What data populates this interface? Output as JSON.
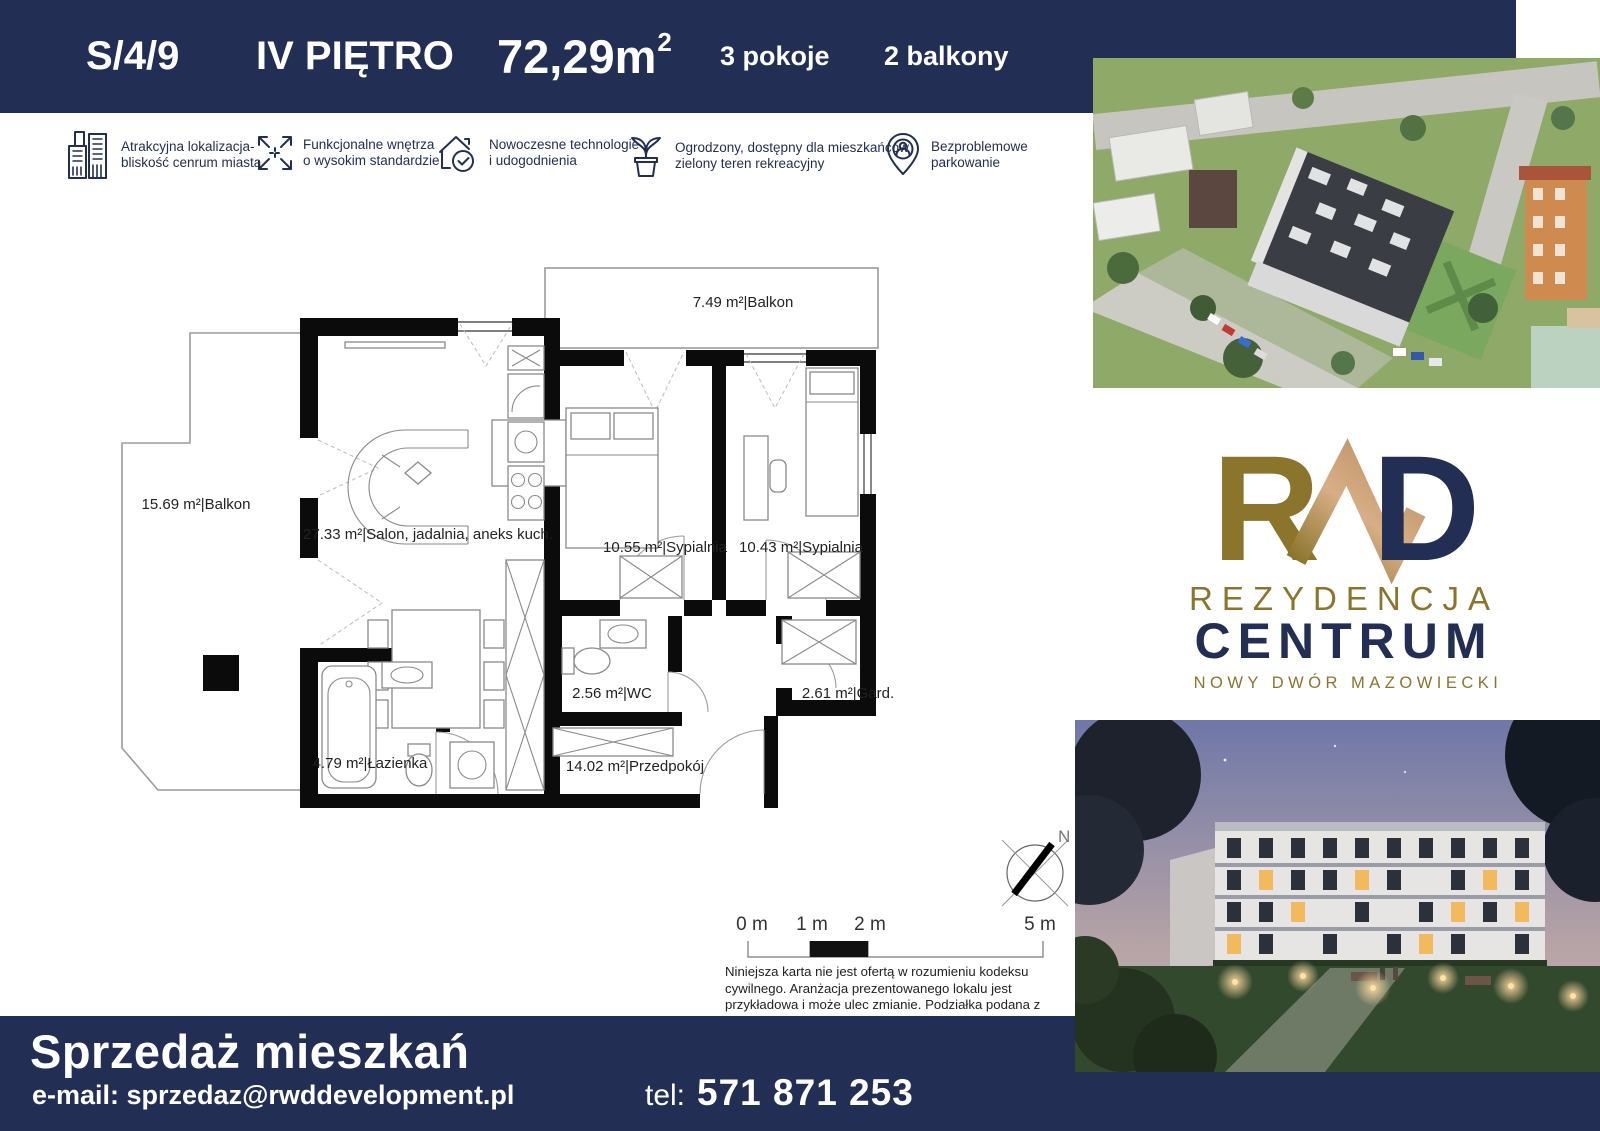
{
  "header": {
    "unit_id": "S/4/9",
    "floor": "IV PIĘTRO",
    "area_main": "72,29m",
    "area_sup": "2",
    "rooms_count": "3 pokoje",
    "balconies_count": "2 balkony"
  },
  "features": [
    {
      "icon": "building-icon",
      "line1": "Atrakcyjna lokalizacja-",
      "line2": "bliskość cenrum miasta"
    },
    {
      "icon": "expand-arrows-icon",
      "line1": "Funkcjonalne wnętrza",
      "line2": "o wysokim standardzie"
    },
    {
      "icon": "house-check-icon",
      "line1": "Nowoczesne technologie",
      "line2": "i udogodnienia"
    },
    {
      "icon": "plant-icon",
      "line1": "Ogrodzony, dostępny dla mieszkańców",
      "line2": "zielony teren rekreacyjny"
    },
    {
      "icon": "parking-pin-icon",
      "line1": "Bezproblemowe",
      "line2": "parkowanie"
    }
  ],
  "plan": {
    "rooms": [
      {
        "name": "balkon-top",
        "label": "7.49 m²|Balkon"
      },
      {
        "name": "balkon-left",
        "label": "15.69 m²|Balkon"
      },
      {
        "name": "salon",
        "label": "27.33 m²|Salon, jadalnia, aneks kuch."
      },
      {
        "name": "sypialnia-1",
        "label": "10.55 m²|Sypialnia"
      },
      {
        "name": "sypialnia-2",
        "label": "10.43 m²|Sypialnia"
      },
      {
        "name": "wc",
        "label": "2.56 m²|WC"
      },
      {
        "name": "garderoba",
        "label": "2.61 m²|Gard."
      },
      {
        "name": "lazienka",
        "label": "4.79 m²|Łazienka"
      },
      {
        "name": "przedpokoj",
        "label": "14.02 m²|Przedpokój"
      }
    ],
    "compass_n": "N",
    "scale_labels": [
      "0 m",
      "1 m",
      "2 m",
      "5 m"
    ],
    "disclaimer": "Niniejsza karta nie jest ofertą w rozumieniu kodeksu cywilnego. Aranżacja prezentowanego lokalu jest przykładowa i może ulec zmianie. Podziałka podana z tolerancją 5%."
  },
  "logo": {
    "letter_r": "R",
    "letter_d": "D",
    "name_line1": "REZYDENCJA",
    "name_line2": "CENTRUM",
    "city": "NOWY DWÓR MAZOWIECKI"
  },
  "footer": {
    "title": "Sprzedaż mieszkań",
    "email": "e-mail: sprzedaz@rwddevelopment.pl",
    "phone_label": "tel:",
    "phone_number": "571 871 253"
  },
  "colors": {
    "navy": "#232E54",
    "gold": "#8B752D",
    "gold_light": "#D8AE86",
    "wall": "#000000"
  }
}
